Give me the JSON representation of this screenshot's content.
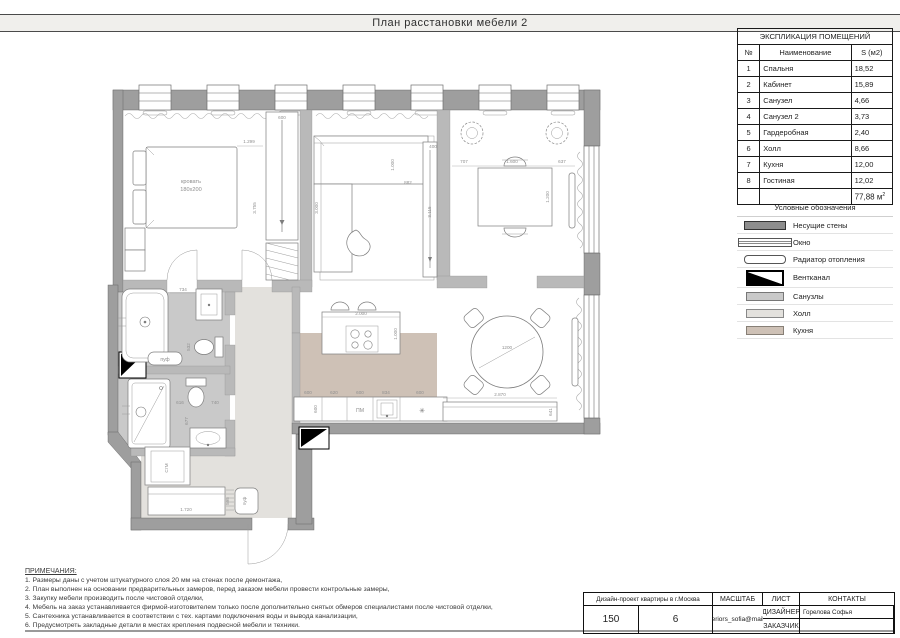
{
  "title": "План расстановки мебели 2",
  "explication": {
    "title": "ЭКСПЛИКАЦИЯ ПОМЕЩЕНИЙ",
    "headers": {
      "num": "№",
      "name": "Наименование",
      "area": "S (м2)"
    },
    "rows": [
      {
        "num": "1",
        "name": "Спальня",
        "area": "18,52"
      },
      {
        "num": "2",
        "name": "Кабинет",
        "area": "15,89"
      },
      {
        "num": "3",
        "name": "Санузел",
        "area": "4,66"
      },
      {
        "num": "4",
        "name": "Санузел 2",
        "area": "3,73"
      },
      {
        "num": "5",
        "name": "Гардеробная",
        "area": "2,40"
      },
      {
        "num": "6",
        "name": "Холл",
        "area": "8,66"
      },
      {
        "num": "7",
        "name": "Кухня",
        "area": "12,00"
      },
      {
        "num": "8",
        "name": "Гостиная",
        "area": "12,02"
      }
    ],
    "total": "77,88 м",
    "total_sup": "2"
  },
  "legend": {
    "title": "Условные обозначения",
    "items": {
      "walls": "Несущие стены",
      "window": "Окно",
      "radiator": "Радиатор отопления",
      "vent": "Вентканал",
      "bath": "Санузлы",
      "hall": "Холл",
      "kitchen": "Кухня"
    }
  },
  "notes": {
    "title": "ПРИМЕЧАНИЯ:",
    "items": [
      "1. Размеры даны с учетом штукатурного слоя 20 мм на стенах после демонтажа,",
      "2. План выполнен на основании предварительных замеров, перед заказом мебели провести контрольные замеры,",
      "3. Закупку мебели производить после чистовой отделки,",
      "4. Мебель на заказ устанавливается фирмой-изготовителем только после дополнительно снятых обмеров специалистами после чистовой отделки,",
      "5. Сантехника устанавливается в соответствии с тех. картами подключения воды и вывода канализации,",
      "6. Предусмотреть закладные детали в местах крепления подвесной мебели и техники."
    ]
  },
  "titleblock": {
    "project": "Дизайн-проект квартиры в г.Москва",
    "designer_label": "ДИЗАЙНЕР",
    "designer_value": "Горелова Софья",
    "client_label": "ЗАКАЗЧИК",
    "client_value": "",
    "scale_label": "МАСШТАБ",
    "scale_value": "150",
    "sheet_label": "ЛИСТ",
    "sheet_value": "6",
    "contacts_label": "КОНТАКТЫ",
    "contacts_value": "interiors_sofia@mail.ru"
  },
  "plan": {
    "labels": {
      "bed_line1": "кровать",
      "bed_line2": "180х200",
      "pouf_bath": "пуф",
      "pouf_hall": "пуф",
      "dishwasher": "ПМ",
      "washer": "СтМ",
      "hob_symbol": "✳"
    },
    "dims": {
      "bed_width": "1.299",
      "bedroom_depth": "3.755",
      "wardrobe_width": "600",
      "sofa_depth": "3.000",
      "sofa_back": "1.000",
      "sofa_width": "882",
      "shelf_height": "3.115",
      "shelf_depth": "400",
      "office_left": "707",
      "desk_width": "1.600",
      "office_right": "637",
      "desk_depth": "1.200",
      "island_width": "2.000",
      "island_depth": "1.000",
      "counter_1": "600",
      "counter_2": "620",
      "counter_3": "600",
      "counter_4": "834",
      "counter_5": "600",
      "counter_depth": "600",
      "table_diameter": "1200",
      "console_width": "2.870",
      "console_gap": "641",
      "bath_dim": "734",
      "wc1_dim": "532",
      "wc2_dim_a": "616",
      "wc2_dim_b": "740",
      "wc2_dim_c": "677",
      "hall_cabinet": "1.720",
      "hall_cabinet_depth": "595"
    }
  }
}
